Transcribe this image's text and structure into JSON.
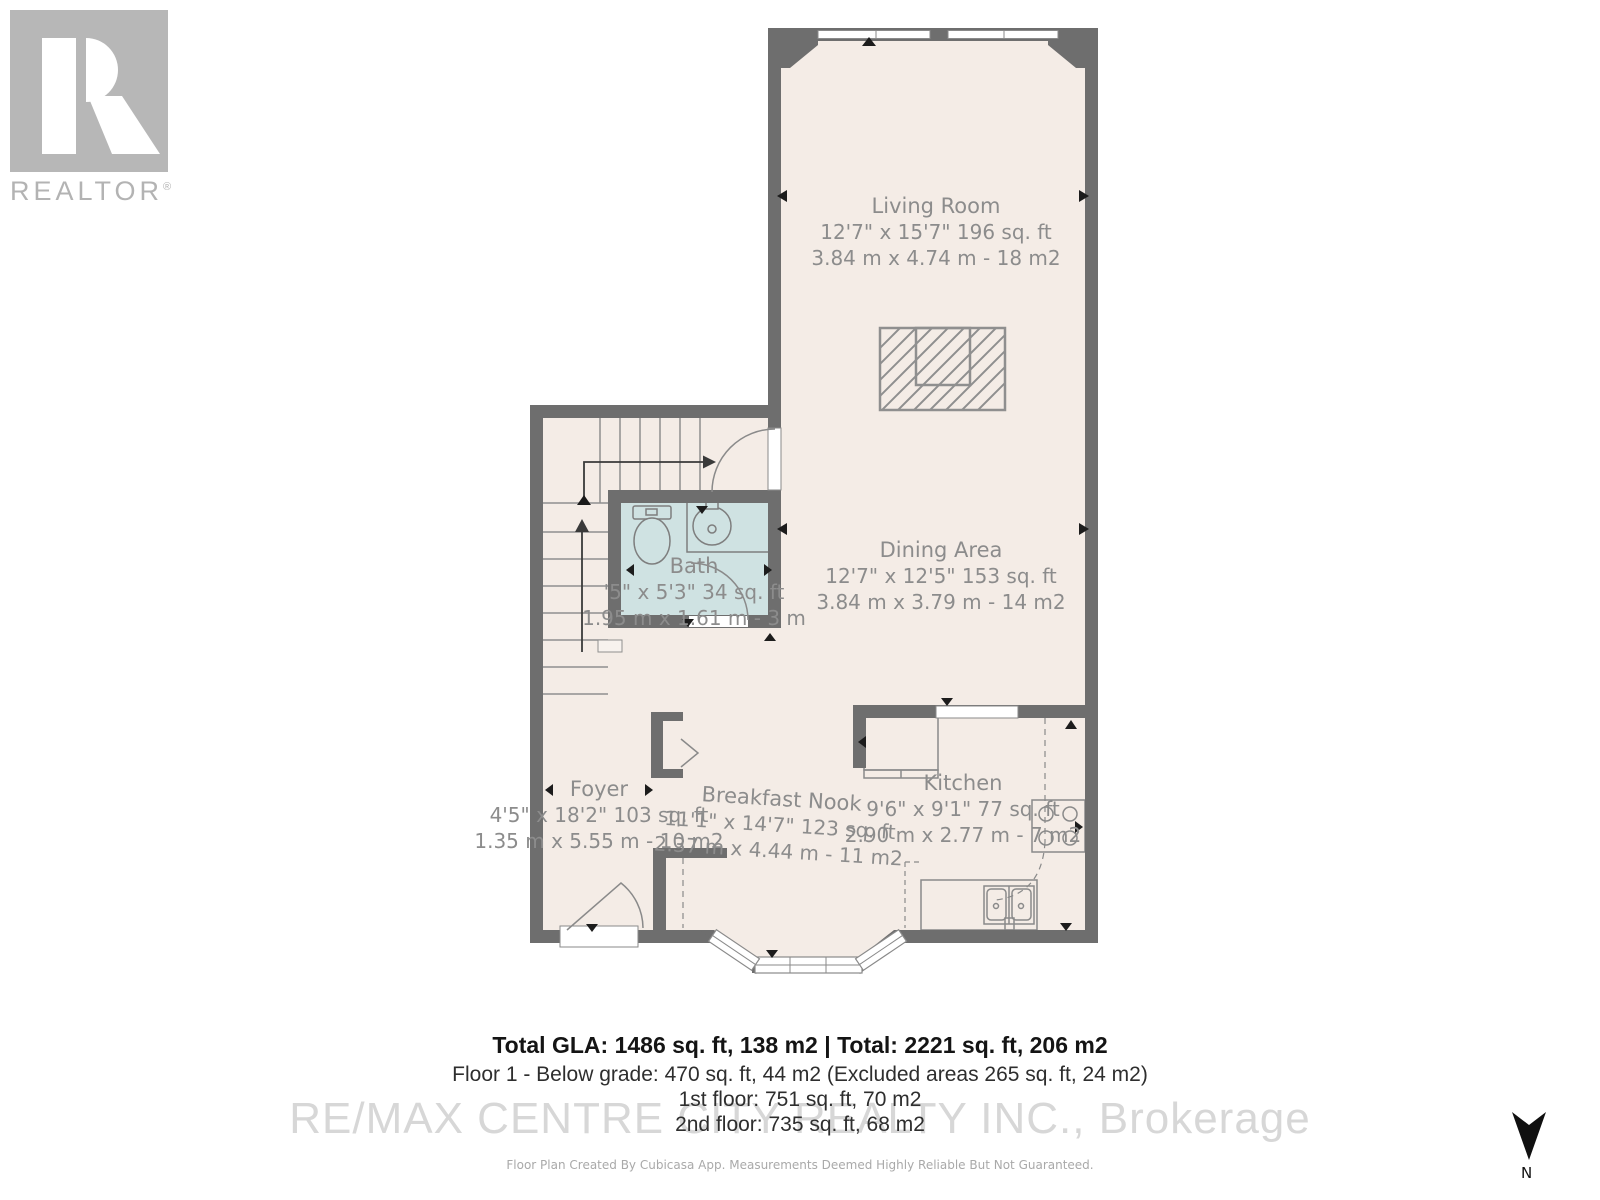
{
  "branding": {
    "logo_letter": "R",
    "logo_word": "REALTOR",
    "logo_reg": "®"
  },
  "rooms": {
    "living": {
      "name": "Living Room",
      "dims_ft": "12'7\" x 15'7\" 196 sq. ft",
      "dims_m": "3.84 m x 4.74 m - 18 m2"
    },
    "dining": {
      "name": "Dining Area",
      "dims_ft": "12'7\" x 12'5\" 153 sq. ft",
      "dims_m": "3.84 m x 3.79 m - 14 m2"
    },
    "bath": {
      "name": "Bath",
      "dims_ft": "'5\" x 5'3\" 34 sq. ft",
      "dims_m": "1.95 m x 1.61 m - 3 m"
    },
    "foyer": {
      "name": "Foyer",
      "dims_ft": "4'5\" x 18'2\" 103 sq. ft",
      "dims_m": "1.35 m x 5.55 m - 10 m2"
    },
    "nook": {
      "name": "Breakfast Nook",
      "dims_ft": "11'1\" x 14'7\" 123 sq. ft",
      "dims_m": "2.37 m x 4.44 m - 11 m2"
    },
    "kitchen": {
      "name": "Kitchen",
      "dims_ft": "9'6\" x 9'1\" 77 sq. ft",
      "dims_m": "2.90 m x 2.77 m - 7 m2"
    }
  },
  "summary": {
    "total": "Total GLA: 1486 sq. ft, 138 m2 | Total: 2221 sq. ft, 206 m2",
    "below_grade": "Floor 1 - Below grade: 470 sq. ft, 44 m2 (Excluded areas 265 sq. ft, 24 m2)",
    "first_floor": "1st floor: 751 sq. ft, 70 m2",
    "second_floor": "2nd floor: 735 sq. ft, 68 m2"
  },
  "watermark": "RE/MAX CENTRE CITY REALTY INC., Brokerage",
  "disclaimer": "Floor Plan Created By Cubicasa App. Measurements Deemed Highly Reliable But Not Guaranteed.",
  "compass": {
    "label": "N"
  },
  "colors": {
    "wall": "#6e6e6e",
    "floor": "#f4ece6",
    "bath_floor": "#cfe2e2",
    "fixture_line": "#8a8a8a",
    "label_text": "#8c8c8c",
    "watermark": "#d7d7d7",
    "logo_gray": "#b7b7b7"
  }
}
